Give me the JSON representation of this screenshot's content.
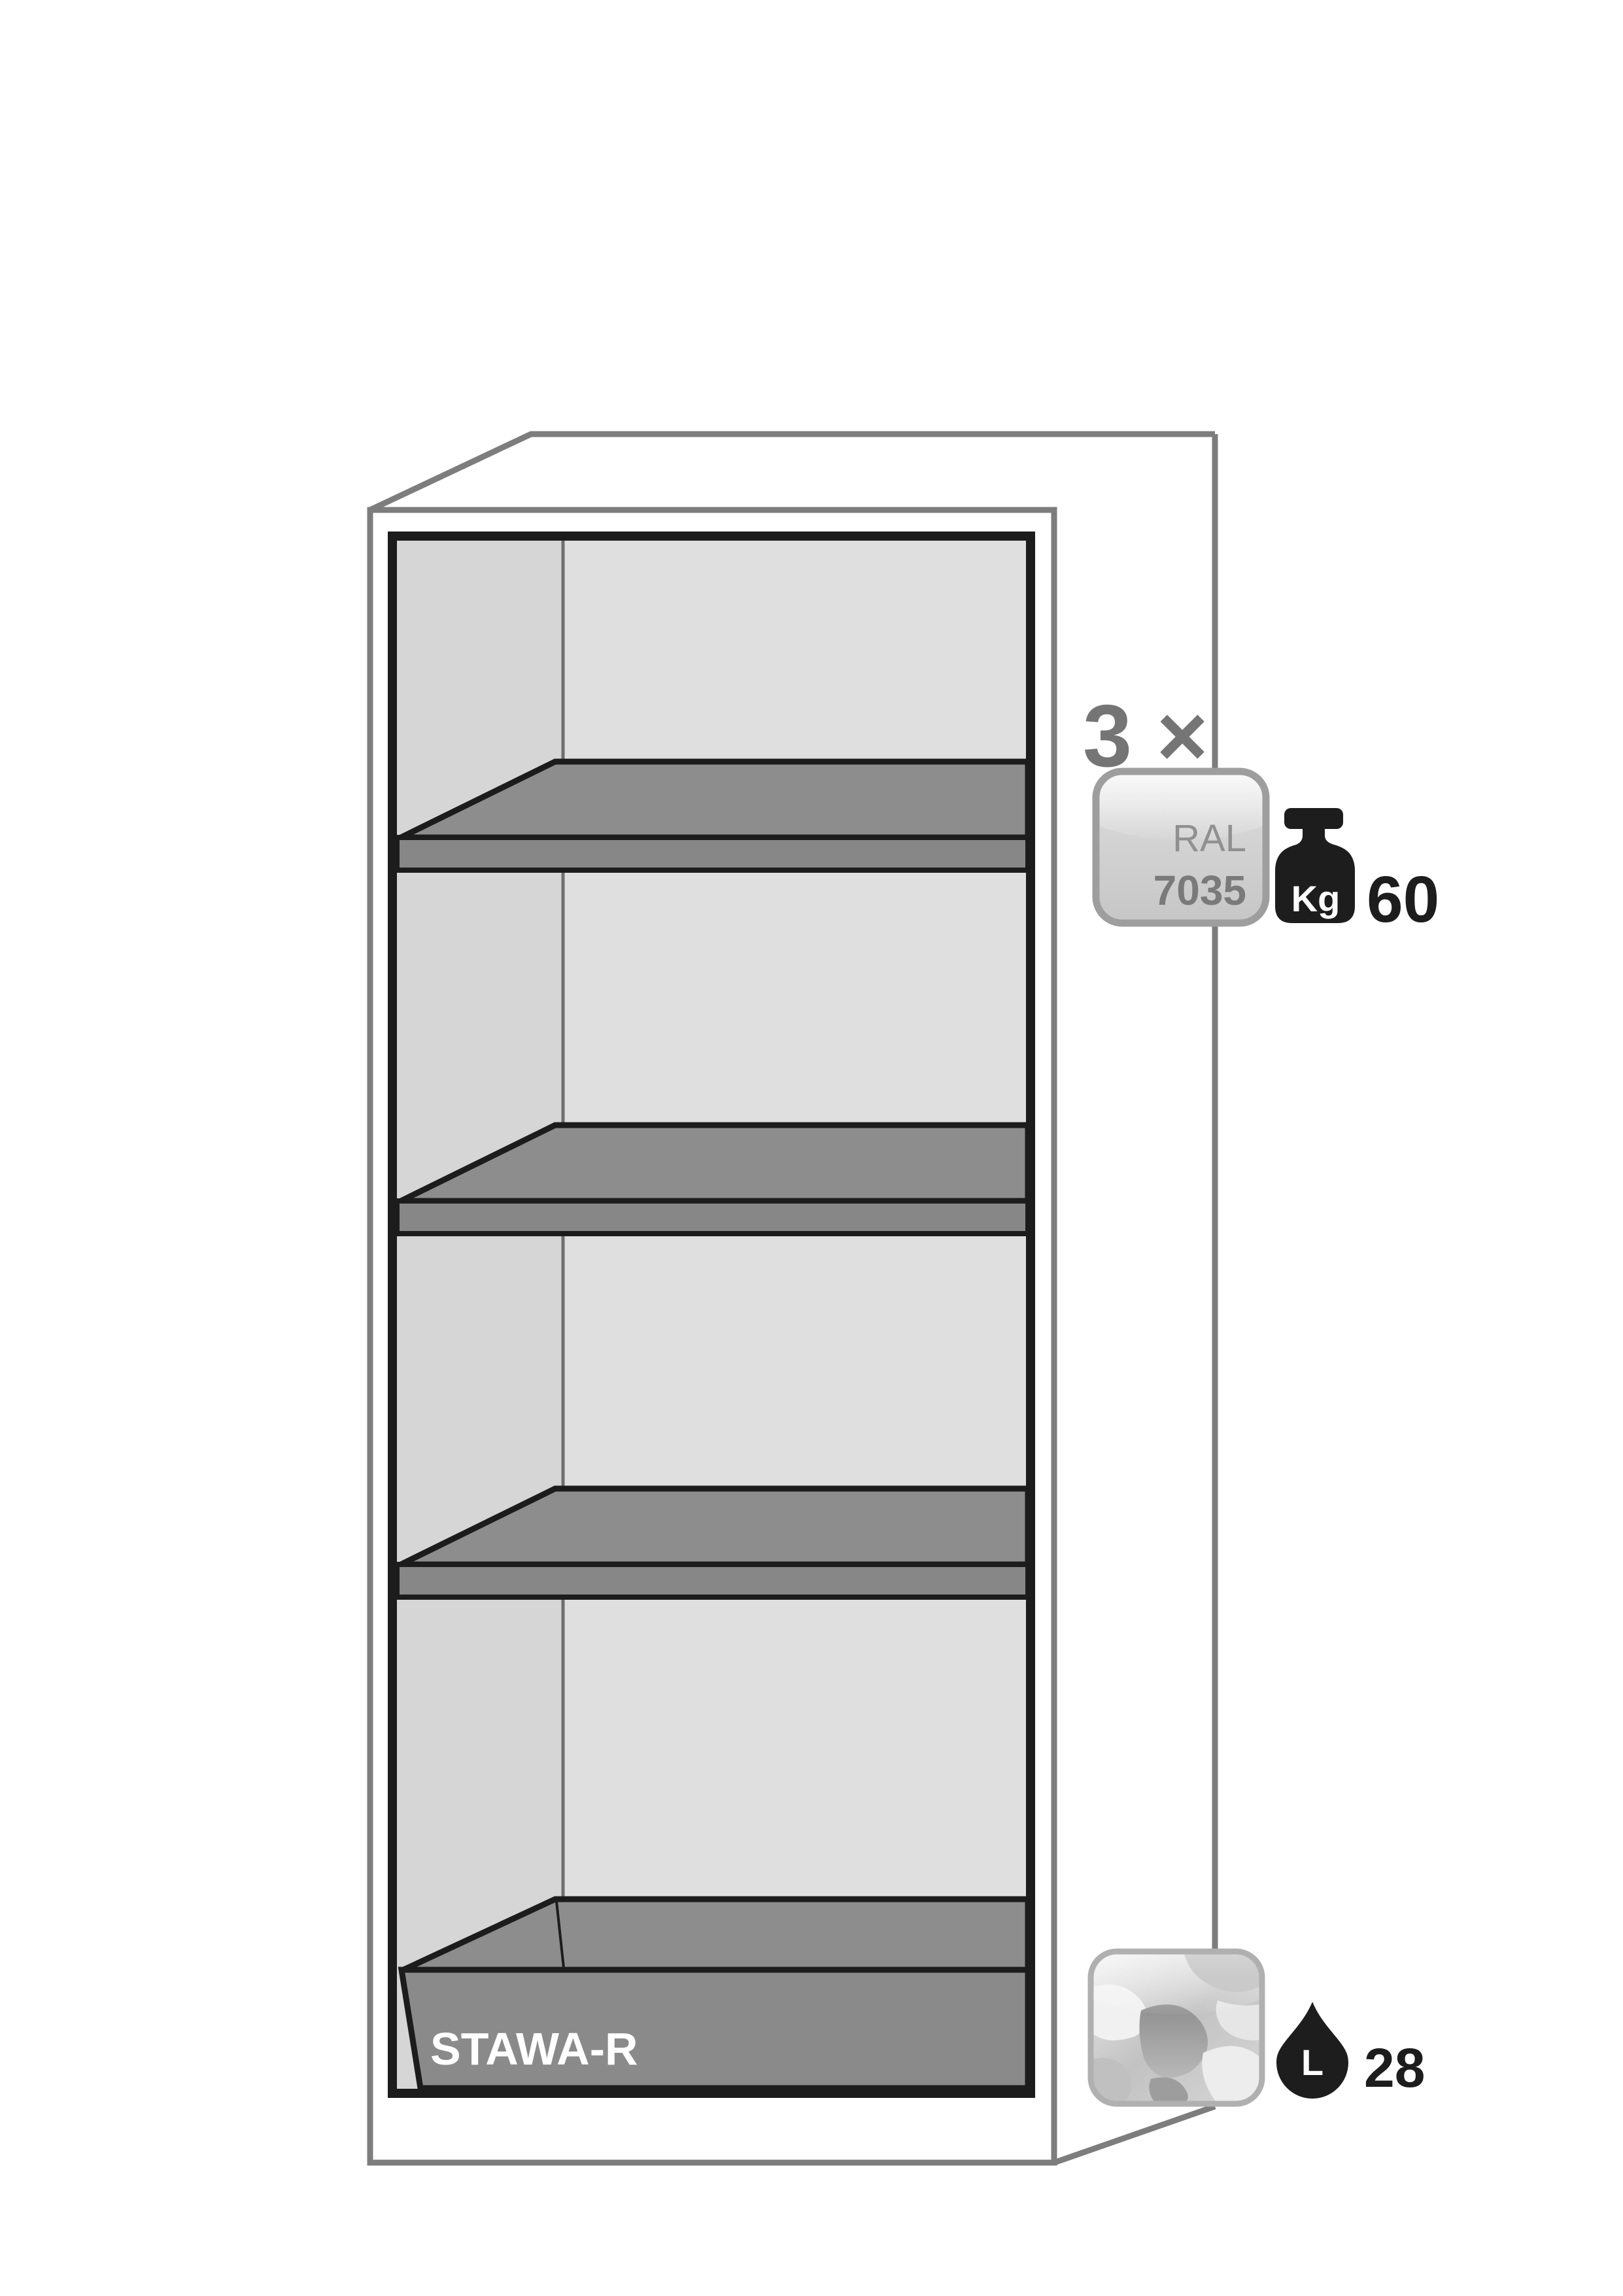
{
  "diagram": {
    "type": "safety-cabinet-interior-equipment",
    "tray_label": "STAWA-R",
    "shelf_count_label": "3 ×",
    "shelves_shown": 4,
    "color_badge": {
      "line1": "RAL",
      "line2": "7035"
    },
    "load_badge": {
      "unit": "Kg",
      "value": "60"
    },
    "volume_badge": {
      "unit": "L",
      "value": "28"
    }
  },
  "colors": {
    "background": "#ffffff",
    "cabinet_outline": "#7d7d7d",
    "interior_frame": "#1c1c1c",
    "back_wall": "#dfdfdf",
    "left_wall": "#d6d6d6",
    "shelf_top": "#8d8d8d",
    "shelf_front": "#878787",
    "tray_gray": "#8a8a8a",
    "badge_border": "#9e9e9e",
    "badge_fill_light": "#dedede",
    "badge_fill_dark": "#c6c6c6",
    "icon_black": "#1d1d1d",
    "count_text": "#757575"
  }
}
